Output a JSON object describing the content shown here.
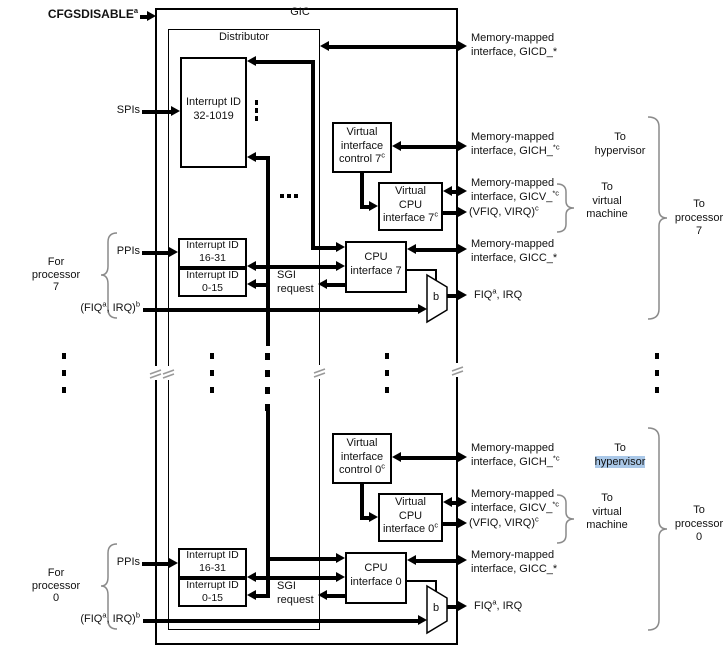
{
  "colors": {
    "line": "#000000",
    "text": "#111111",
    "brace": "#8a8a8a",
    "selection_highlight": "#aac8e8"
  },
  "gic": {
    "title": "GIC",
    "distributor": "Distributor"
  },
  "signals": {
    "cfgsdisable": {
      "base": "CFGSDISABLE",
      "sup": "a"
    },
    "spis": "SPIs",
    "ppis": "PPIs",
    "sgi_request": {
      "l1": "SGI",
      "l2": "request"
    },
    "fiq_irq_in": {
      "b1": "(FIQ",
      "s1": "a",
      "b2": ", IRQ)",
      "s2": "b"
    },
    "fiq_irq_out": {
      "b1": "FIQ",
      "s1": "a",
      "b2": ", IRQ"
    },
    "mux": "b"
  },
  "blocks": {
    "interrupt_spi": {
      "l1": "Interrupt ID",
      "l2": "32-1019"
    },
    "interrupt_ppi": {
      "l1": "Interrupt ID",
      "l2": "16-31"
    },
    "interrupt_sgi": {
      "l1": "Interrupt ID",
      "l2": "0-15"
    }
  },
  "interfaces": {
    "gicd": {
      "l1": "Memory-mapped",
      "l2": "interface, GICD_*"
    },
    "gich": {
      "l1": "Memory-mapped",
      "l2": "interface, GICH_",
      "sup": "*c"
    },
    "gicv": {
      "l1": "Memory-mapped",
      "l2": "interface, GICV_",
      "sup": "*c"
    },
    "vfiq_virq": {
      "base": "(VFIQ, VIRQ)",
      "sup": "c"
    },
    "gicc": {
      "l1": "Memory-mapped",
      "l2": "interface, GICC_*"
    }
  },
  "destinations": {
    "to_hypervisor": {
      "l1": "To",
      "l2": "hypervisor"
    },
    "to_virtual_machine": {
      "l1": "To",
      "l2": "virtual",
      "l3": "machine"
    }
  },
  "p7": {
    "virtual_interface_control": {
      "l1": "Virtual",
      "l2": "interface",
      "l3": "control 7",
      "sup": "c"
    },
    "virtual_cpu_interface": {
      "l1": "Virtual",
      "l2": "CPU",
      "l3": "interface 7",
      "sup": "c"
    },
    "cpu_interface": {
      "l1": "CPU",
      "l2": "interface 7"
    },
    "for_processor": {
      "l1": "For",
      "l2": "processor",
      "l3": "7"
    },
    "to_processor": {
      "l1": "To",
      "l2": "processor",
      "l3": "7"
    }
  },
  "p0": {
    "virtual_interface_control": {
      "l1": "Virtual",
      "l2": "interface",
      "l3": "control 0",
      "sup": "c"
    },
    "virtual_cpu_interface": {
      "l1": "Virtual",
      "l2": "CPU",
      "l3": "interface 0",
      "sup": "c"
    },
    "cpu_interface": {
      "l1": "CPU",
      "l2": "interface 0"
    },
    "for_processor": {
      "l1": "For",
      "l2": "processor",
      "l3": "0"
    },
    "to_processor": {
      "l1": "To",
      "l2": "processor",
      "l3": "0"
    }
  }
}
